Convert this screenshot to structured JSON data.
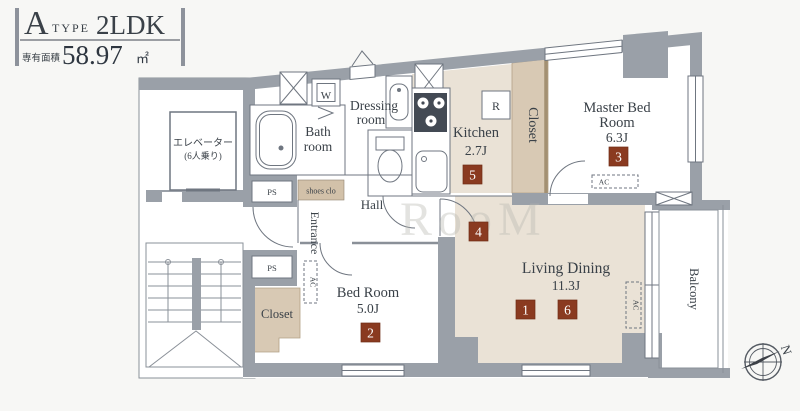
{
  "title": {
    "type_letter": "A",
    "type_word": "TYPE",
    "layout": "2LDK",
    "area_label": "専有面積",
    "area_value": "58.97",
    "area_unit": "㎡"
  },
  "rooms": {
    "elevator": {
      "name": "エレベーター",
      "capacity": "(6人乗り)"
    },
    "bath": {
      "line1": "Bath",
      "line2": "room"
    },
    "dressing": {
      "line1": "Dressing",
      "line2": "room"
    },
    "kitchen": {
      "name": "Kitchen",
      "size": "2.7J"
    },
    "closet_kitchen": "Closet",
    "master": {
      "line1": "Master Bed",
      "line2": "Room",
      "size": "6.3J"
    },
    "living": {
      "name": "Living Dining",
      "size": "11.3J"
    },
    "bedroom": {
      "name": "Bed Room",
      "size": "5.0J"
    },
    "closet_bedroom": "Closet",
    "hall": "Hall",
    "entrance": "Entrance",
    "shoes_closet": "shoes clo",
    "balcony": "Balcony"
  },
  "labels": {
    "ps": "PS",
    "ac": "AC",
    "washer": "W",
    "fridge": "R",
    "north": "N"
  },
  "markers": [
    "1",
    "2",
    "3",
    "4",
    "5",
    "6"
  ],
  "watermark": "RooM",
  "colors": {
    "wall": "#9aa0a8",
    "floor_beige": "#eae2d6",
    "closet_tan": "#d8c9b4",
    "marker_red": "#8a3a20",
    "text": "#3a4148"
  }
}
